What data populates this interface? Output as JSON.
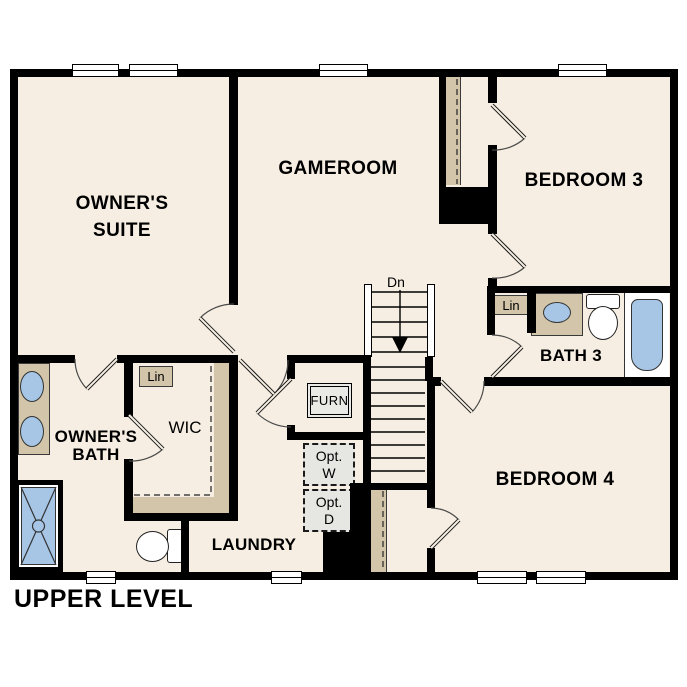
{
  "title": "UPPER LEVEL",
  "rooms": {
    "owners_suite": {
      "line1": "OWNER'S",
      "line2": "SUITE"
    },
    "gameroom": {
      "label": "GAMEROOM"
    },
    "bedroom3": {
      "label": "BEDROOM 3"
    },
    "bath3": {
      "label": "BATH 3"
    },
    "bedroom4": {
      "label": "BEDROOM 4"
    },
    "owners_bath": {
      "line1": "OWNER'S",
      "line2": "BATH"
    },
    "wic": {
      "label": "WIC"
    },
    "laundry": {
      "label": "LAUNDRY"
    }
  },
  "features": {
    "stairs_direction": "Dn",
    "furnace": "FURN",
    "linen_wic": "Lin",
    "linen_bath3": "Lin",
    "washer": {
      "line1": "Opt.",
      "line2": "W"
    },
    "dryer": {
      "line1": "Opt.",
      "line2": "D"
    }
  },
  "colors": {
    "wall": "#000000",
    "floor": "#f6eee2",
    "casework_tan": "#d2c5a9",
    "fixture_blue": "#a7c6e6",
    "appliance_gray": "#e6e6e3",
    "background": "#ffffff"
  }
}
